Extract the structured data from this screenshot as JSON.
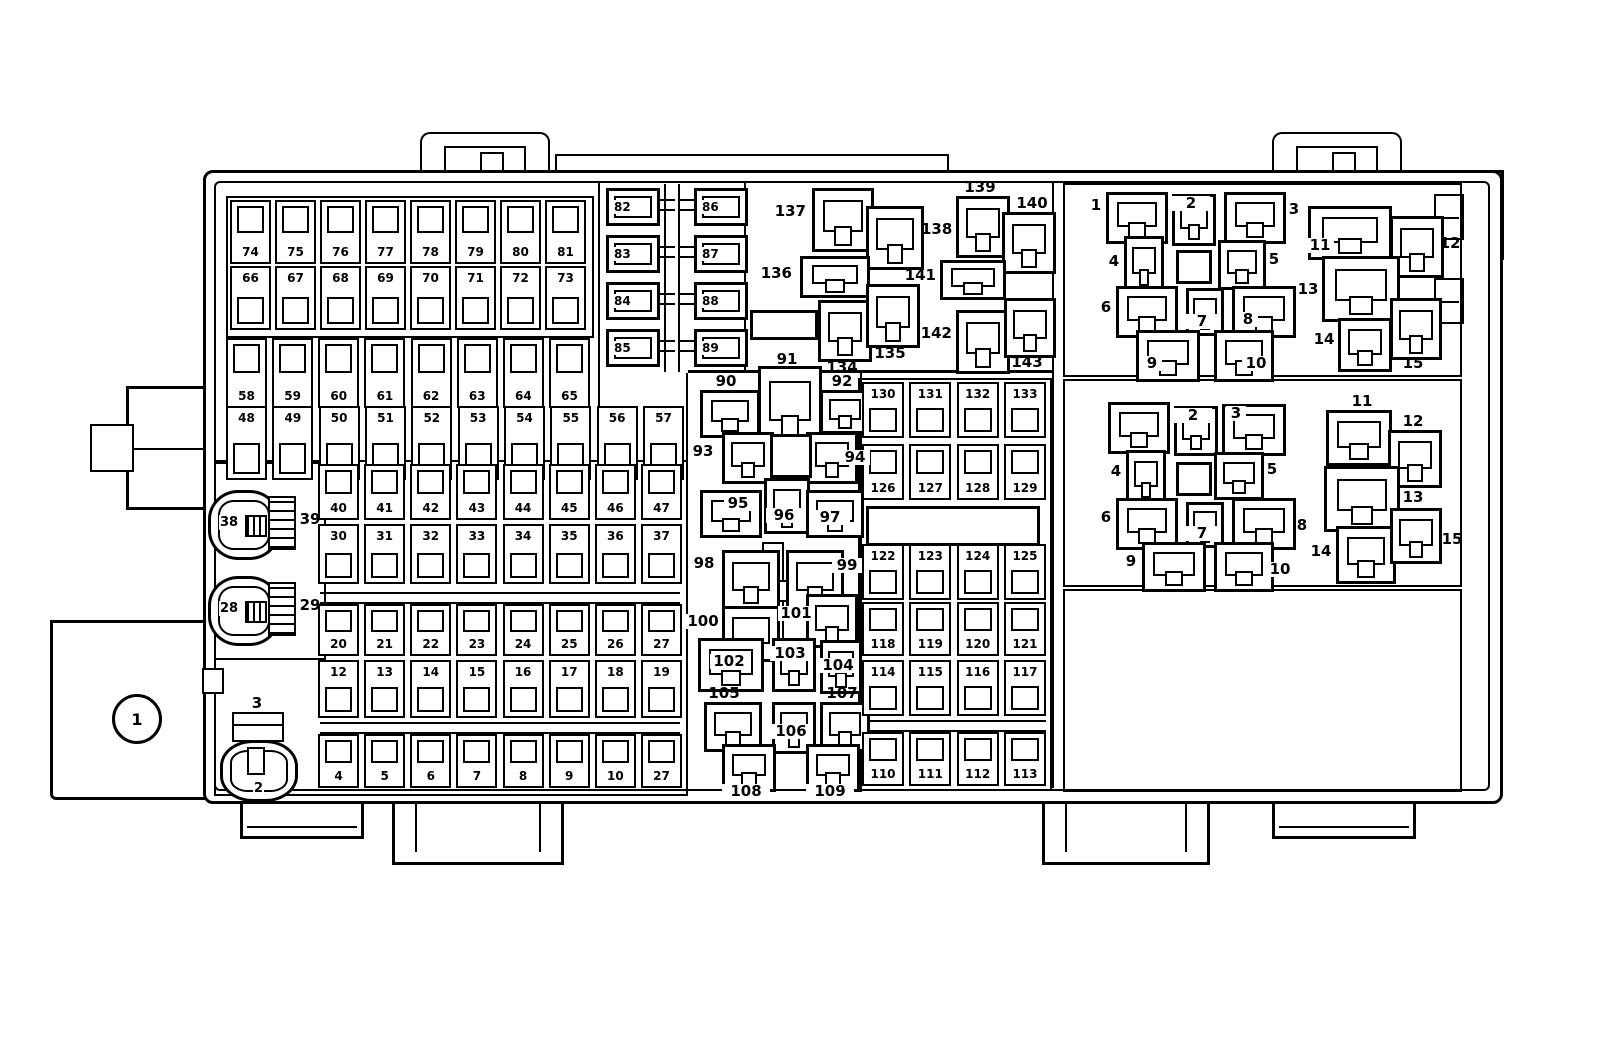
{
  "figure": {
    "kind": "fuse-box-diagram",
    "ink": "#000000",
    "paper": "#ffffff"
  },
  "callouts": {
    "main": "1",
    "connector_lower": "2",
    "bracket_upper": "3",
    "connector_mid": "28",
    "strip_mid": "29",
    "connector_top": "38",
    "strip_top": "39"
  },
  "fuse_rows": {
    "r74_81": [
      "74",
      "75",
      "76",
      "77",
      "78",
      "79",
      "80",
      "81"
    ],
    "r66_73": [
      "66",
      "67",
      "68",
      "69",
      "70",
      "71",
      "72",
      "73"
    ],
    "r58_65": [
      "58",
      "59",
      "60",
      "61",
      "62",
      "63",
      "64",
      "65"
    ],
    "r48_57": [
      "48",
      "49",
      "50",
      "51",
      "52",
      "53",
      "54",
      "55",
      "56",
      "57"
    ],
    "r40_47": [
      "40",
      "41",
      "42",
      "43",
      "44",
      "45",
      "46",
      "47"
    ],
    "r30_37": [
      "30",
      "31",
      "32",
      "33",
      "34",
      "35",
      "36",
      "37"
    ],
    "r20_27": [
      "20",
      "21",
      "22",
      "23",
      "24",
      "25",
      "26",
      "27"
    ],
    "r12_19": [
      "12",
      "13",
      "14",
      "15",
      "16",
      "17",
      "18",
      "19"
    ],
    "r4_11": [
      "4",
      "5",
      "6",
      "7",
      "8",
      "9",
      "10",
      "27"
    ]
  },
  "cartridge_fuses": {
    "left": [
      "82",
      "83",
      "84",
      "85"
    ],
    "right": [
      "86",
      "87",
      "88",
      "89"
    ]
  },
  "grid_rows": {
    "r130_133": [
      "130",
      "131",
      "132",
      "133"
    ],
    "r126_129": [
      "126",
      "127",
      "128",
      "129"
    ],
    "r122_125": [
      "122",
      "123",
      "124",
      "125"
    ],
    "r118_121": [
      "118",
      "119",
      "120",
      "121"
    ],
    "r114_117": [
      "114",
      "115",
      "116",
      "117"
    ],
    "r110_113": [
      "110",
      "111",
      "112",
      "113"
    ]
  },
  "relay_bay": {
    "r134": "134",
    "r135": "135",
    "r136": "136",
    "r137": "137",
    "r138": "138",
    "r139": "139",
    "r140": "140",
    "r141": "141",
    "r142": "142",
    "r143": "143"
  },
  "center_bay": {
    "r90": "90",
    "r91": "91",
    "r92": "92",
    "r93": "93",
    "r94": "94",
    "r95": "95",
    "r96": "96",
    "r97": "97",
    "r98": "98",
    "r99": "99",
    "r100": "100",
    "r101": "101",
    "r102": "102",
    "r103": "103",
    "r104": "104",
    "r105": "105",
    "r106": "106",
    "r107": "107",
    "r108": "108",
    "r109": "109"
  },
  "right_bay_top": {
    "p1": "1",
    "p2": "2",
    "p3": "3",
    "p4": "4",
    "p5": "5",
    "p6": "6",
    "p7": "7",
    "p8": "8",
    "p9": "9",
    "p10": "10",
    "p11": "11",
    "p12": "12",
    "p13": "13",
    "p14": "14",
    "p15": "15"
  },
  "right_bay_mid": {
    "p2": "2",
    "p3": "3",
    "p4": "4",
    "p5": "5",
    "p6": "6",
    "p7": "7",
    "p8": "8",
    "p9": "9",
    "p10": "10",
    "p11": "11",
    "p12": "12",
    "p13": "13",
    "p14": "14",
    "p15": "15"
  }
}
